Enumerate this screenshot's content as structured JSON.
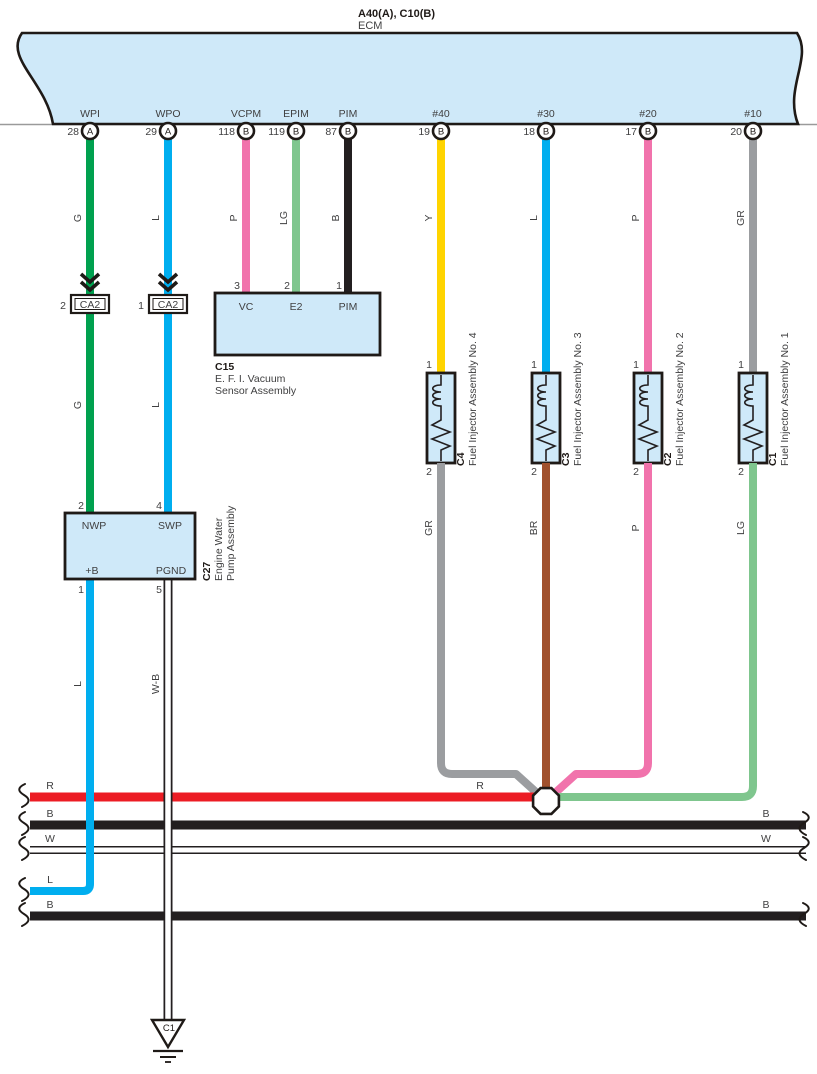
{
  "header": {
    "title": "A40(A), C10(B)",
    "subtitle": "ECM"
  },
  "colors": {
    "band_fill": "#cfe9f9",
    "box_fill": "#cfe9f9",
    "outline": "#231f20",
    "text": "#404041",
    "green": "#00a14f",
    "blue": "#00aeef",
    "pink": "#f173ac",
    "light_green": "#7fc68e",
    "black_wire": "#231f20",
    "yellow": "#ffd400",
    "gray": "#9b9da0",
    "brown": "#a1512d",
    "red": "#ec1c24",
    "white_wire": "#ffffff"
  },
  "ecm_pins": [
    {
      "name": "WPI",
      "number": "28",
      "connector": "A",
      "wire": "G"
    },
    {
      "name": "WPO",
      "number": "29",
      "connector": "A",
      "wire": "L"
    },
    {
      "name": "VCPM",
      "number": "118",
      "connector": "B",
      "wire": "P"
    },
    {
      "name": "EPIM",
      "number": "119",
      "connector": "B",
      "wire": "LG"
    },
    {
      "name": "PIM",
      "number": "87",
      "connector": "B",
      "wire": "B"
    },
    {
      "name": "#40",
      "number": "19",
      "connector": "B",
      "wire": "Y"
    },
    {
      "name": "#30",
      "number": "18",
      "connector": "B",
      "wire": "L"
    },
    {
      "name": "#20",
      "number": "17",
      "connector": "B",
      "wire": "P"
    },
    {
      "name": "#10",
      "number": "20",
      "connector": "B",
      "wire": "GR"
    }
  ],
  "ca2": [
    {
      "pin": "2",
      "label": "CA2",
      "wire_below": "G"
    },
    {
      "pin": "1",
      "label": "CA2",
      "wire_below": "L"
    }
  ],
  "c15": {
    "id": "C15",
    "desc1": "E. F. I.  Vacuum",
    "desc2": "Sensor Assembly",
    "pins": [
      {
        "number": "3",
        "name": "VC"
      },
      {
        "number": "2",
        "name": "E2"
      },
      {
        "number": "1",
        "name": "PIM"
      }
    ]
  },
  "c27": {
    "id": "C27",
    "desc1": "Engine Water",
    "desc2": "Pump Assembly",
    "pin_nwp": {
      "number": "2",
      "name": "NWP"
    },
    "pin_swp": {
      "number": "4",
      "name": "SWP"
    },
    "pin_plus_b": {
      "number": "1",
      "name": "+B",
      "wire_below": "L"
    },
    "pin_pgnd": {
      "number": "5",
      "name": "PGND",
      "wire_below": "W-B"
    }
  },
  "injectors": [
    {
      "id": "C4",
      "name": "Fuel Injector Assembly No. 4",
      "pin_top": "1",
      "pin_bottom": "2",
      "wire_below": "GR"
    },
    {
      "id": "C3",
      "name": "Fuel Injector Assembly No. 3",
      "pin_top": "1",
      "pin_bottom": "2",
      "wire_below": "BR"
    },
    {
      "id": "C2",
      "name": "Fuel Injector Assembly No. 2",
      "pin_top": "1",
      "pin_bottom": "2",
      "wire_below": "P"
    },
    {
      "id": "C1",
      "name": "Fuel Injector Assembly No. 1",
      "pin_top": "1",
      "pin_bottom": "2",
      "wire_below": "LG"
    }
  ],
  "bus_labels": {
    "red_left": "R",
    "red_mid": "R",
    "black1_left": "B",
    "black1_right": "B",
    "white_left": "W",
    "white_right": "W",
    "blue_left": "L",
    "black2_left": "B",
    "black2_right": "B"
  },
  "ground": {
    "id": "C1"
  }
}
